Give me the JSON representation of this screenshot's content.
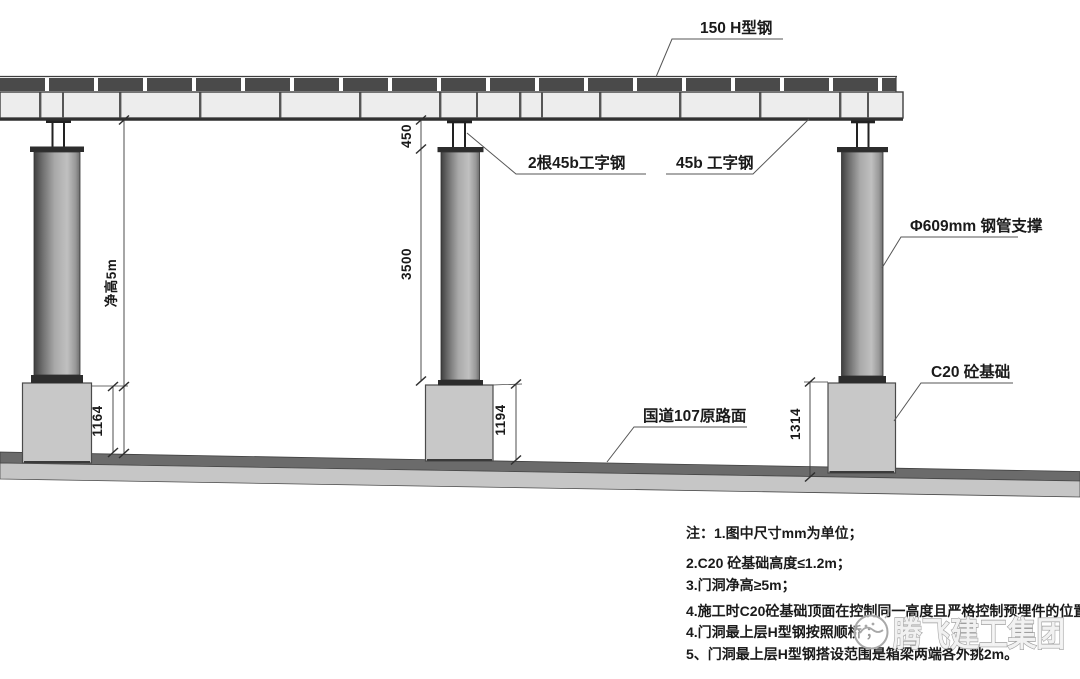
{
  "drawing": {
    "type": "construction-elevation-diagram",
    "colors": {
      "line": "#3a3a3a",
      "h_steel_dark": "#4a4a4a",
      "beam_fill": "#ededed",
      "column_dark": "#3f3f3f",
      "column_light": "#c2c2c2",
      "foundation_fill": "#c8c8c8",
      "road_dark": "#6b6b6b",
      "road_light": "#c6c6c6",
      "watermark_outline": "#a0a0a0"
    },
    "labels": {
      "h_beam": "150 H型钢",
      "double_i_beam": "2根45b工字钢",
      "i_beam": "45b 工字钢",
      "pipe_support": "Φ609mm 钢管支撑",
      "foundation": "C20 砼基础",
      "road": "国道107原路面"
    },
    "dimensions": {
      "stub_height": "450",
      "column_height": "3500",
      "clear_height": "净高5m",
      "foundation_left": "1164",
      "foundation_middle": "1194",
      "foundation_right": "1314"
    },
    "notes": [
      "注：1.图中尺寸mm为单位；",
      "2.C20 砼基础高度≤1.2m；",
      "3.门洞净高≥5m；",
      "4.施工时C20砼基础顶面在控制同一高度且严格控制预埋件的位置；",
      "4.门洞最上层H型钢按照顺桥 ；",
      "5、门洞最上层H型钢搭设范围是箱梁两端各外挑2m。"
    ],
    "watermark": {
      "text": "腾飞建工集团"
    }
  }
}
